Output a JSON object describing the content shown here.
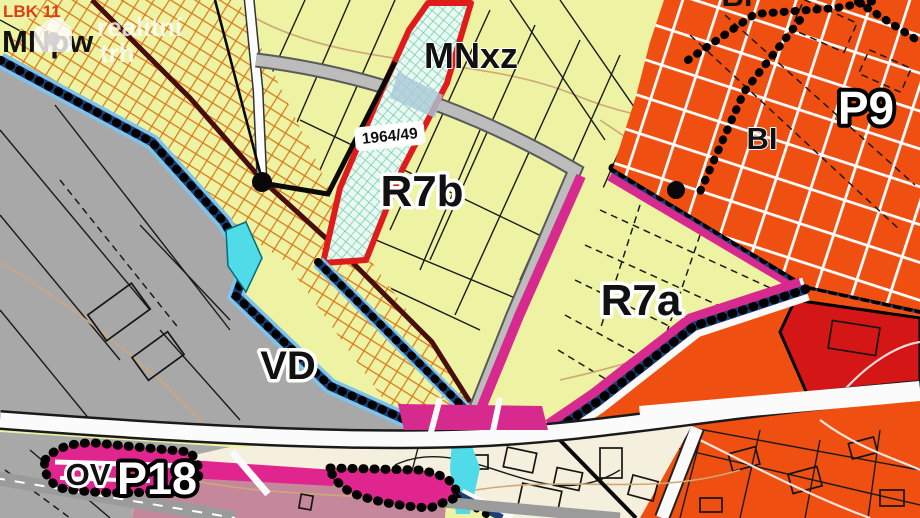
{
  "watermark": {
    "line1": "realitní",
    "line2": "trh"
  },
  "labels": {
    "lbk11": "LBK 11",
    "mnpw": "MNpw",
    "mnxz": "MNxz",
    "parcel_number": "1964/49",
    "r7b": "R7b",
    "r7a": "R7a",
    "bi": "BI",
    "bi_top": "BI",
    "p9": "P9",
    "vd": "VD",
    "ov": "OV",
    "p18": "P18"
  },
  "colors": {
    "base_yellow": "#edf3a2",
    "zone_orange": "#f04f12",
    "zone_red": "#d41616",
    "zone_gray": "#a8a8a8",
    "zone_rose": "#c5879b",
    "zone_cream": "#f4f0dd",
    "zone_magenta": "#e0268e",
    "band_magenta": "#d62a8e",
    "band_navy": "#1c3f77",
    "band_lightblue": "#7fc3e8",
    "water_cyan": "#4fdbe8",
    "parcel_red_outline": "#e01b1b",
    "parcel_teal_hatch": "#54c9a9",
    "corridor_hatch_orange": "#dd7518",
    "corridor_line_maroon": "#4a0d0d",
    "label_red": "#e03c14"
  }
}
